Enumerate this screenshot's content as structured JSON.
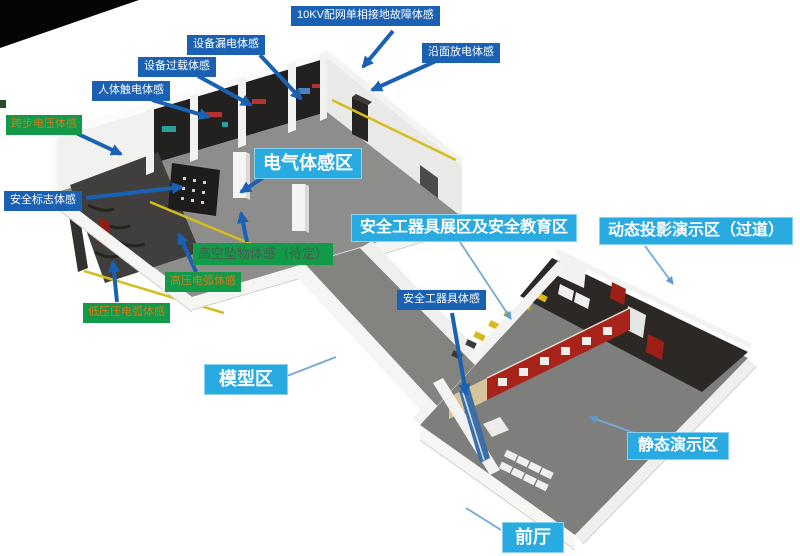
{
  "diagram": {
    "type": "isometric-floor-plan",
    "background": "#ffffff"
  },
  "colors": {
    "label-blue": "#1b61b3",
    "label-cyan": "#29abe2",
    "label-green": "#119a48",
    "green-text-orange": "#d9781c",
    "green-text-dark": "#4d594f",
    "arrow-blue": "#1b61b3",
    "leader-blue": "#74a9d8",
    "floor-gray": "#8d8d8b",
    "dark-zone": "#2c2825",
    "wall-white": "#f5f5f3",
    "accent-yellow": "#d4bd1e",
    "display-red": "#a8241b"
  },
  "labels": [
    {
      "id": "ten-kv-fault",
      "text": "10KV配网单相接地故障体感",
      "style": "blue"
    },
    {
      "id": "equip-leakage",
      "text": "设备漏电体感",
      "style": "blue"
    },
    {
      "id": "equip-overload",
      "text": "设备过载体感",
      "style": "blue"
    },
    {
      "id": "human-shock",
      "text": "人体触电体感",
      "style": "blue"
    },
    {
      "id": "surface-discharge",
      "text": "沿面放电体感",
      "style": "blue"
    },
    {
      "id": "step-voltage",
      "text": "跨步电压体感",
      "style": "green-orange"
    },
    {
      "id": "safety-sign",
      "text": "安全标志体感",
      "style": "blue"
    },
    {
      "id": "electric-zone",
      "text": "电气体感区",
      "style": "cyan-large"
    },
    {
      "id": "falling-object",
      "text": "高空坠物体感（待定）",
      "style": "green-dark"
    },
    {
      "id": "hv-arc",
      "text": "高压电弧体感",
      "style": "green-orange"
    },
    {
      "id": "lv-arc",
      "text": "低压压电弧体感",
      "style": "green-orange"
    },
    {
      "id": "tool-exhibit-zone",
      "text": "安全工器具展区及安全教育区",
      "style": "cyan"
    },
    {
      "id": "dynamic-projection",
      "text": "动态投影演示区（过道）",
      "style": "cyan"
    },
    {
      "id": "tool-experience",
      "text": "安全工器具体感",
      "style": "blue"
    },
    {
      "id": "model-zone",
      "text": "模型区",
      "style": "cyan"
    },
    {
      "id": "static-demo",
      "text": "静态演示区",
      "style": "cyan"
    },
    {
      "id": "front-hall",
      "text": "前厅",
      "style": "cyan"
    }
  ]
}
